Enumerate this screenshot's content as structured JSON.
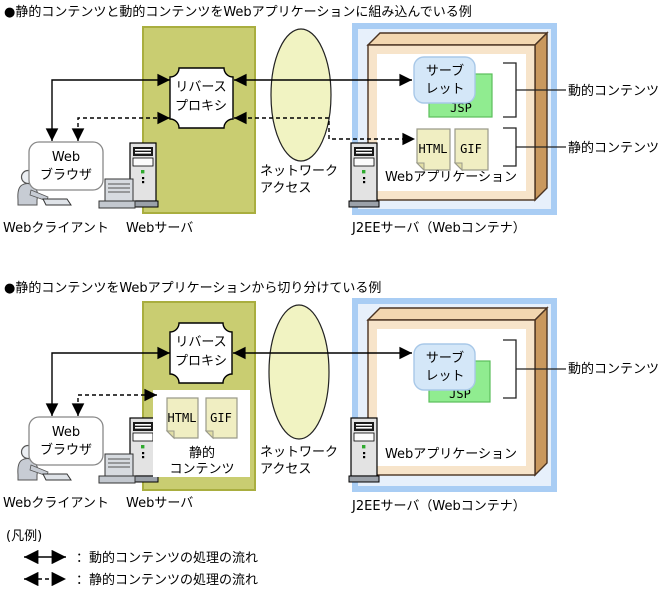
{
  "colors": {
    "web_server_fill": "#c9cd71",
    "web_server_stroke": "#a9ae3f",
    "network_fill": "#f1f3c2",
    "j2ee_border": "#a9cdf4",
    "j2ee_fill": "#e7f0fb",
    "box_top": "#f3d7b0",
    "box_side": "#c9985e",
    "box_front": "#f7e4ca",
    "servlet_fill": "#d4e7f8",
    "servlet_stroke": "#a8c8e8",
    "jsp_fill": "#90ec90",
    "jsp_stroke": "#5abf5a",
    "doc_fill": "#f0eec2",
    "doc_stroke": "#9a9a8a",
    "arrow": "#000000"
  },
  "sections": [
    {
      "title": "●静的コンテンツと動的コンテンツをWebアプリケーションに組み込んでいる例",
      "client": {
        "label": "Webクライアント",
        "browser_line1": "Web",
        "browser_line2": "ブラウザ"
      },
      "web_server": {
        "label": "Webサーバ",
        "proxy_line1": "リバース",
        "proxy_line2": "プロキシ"
      },
      "network": {
        "line1": "ネットワーク",
        "line2": "アクセス"
      },
      "j2ee": {
        "label": "J2EEサーバ（Webコンテナ）",
        "webapp_label": "Webアプリケーション",
        "servlet_line1": "サーブ",
        "servlet_line2": "レット",
        "jsp": "JSP",
        "html": "HTML",
        "gif": "GIF",
        "dynamic_label": "動的コンテンツ",
        "static_label": "静的コンテンツ"
      }
    },
    {
      "title": "●静的コンテンツをWebアプリケーションから切り分けている例",
      "client": {
        "label": "Webクライアント",
        "browser_line1": "Web",
        "browser_line2": "ブラウザ"
      },
      "web_server": {
        "label": "Webサーバ",
        "proxy_line1": "リバース",
        "proxy_line2": "プロキシ",
        "static_store": {
          "html": "HTML",
          "gif": "GIF",
          "caption_line1": "静的",
          "caption_line2": "コンテンツ"
        }
      },
      "network": {
        "line1": "ネットワーク",
        "line2": "アクセス"
      },
      "j2ee": {
        "label": "J2EEサーバ（Webコンテナ）",
        "webapp_label": "Webアプリケーション",
        "servlet_line1": "サーブ",
        "servlet_line2": "レット",
        "jsp": "JSP",
        "dynamic_label": "動的コンテンツ"
      }
    }
  ],
  "legend": {
    "title": "(凡例)",
    "items": [
      {
        "style": "solid",
        "label": "：動的コンテンツの処理の流れ"
      },
      {
        "style": "dashed",
        "label": "：静的コンテンツの処理の流れ"
      }
    ]
  }
}
